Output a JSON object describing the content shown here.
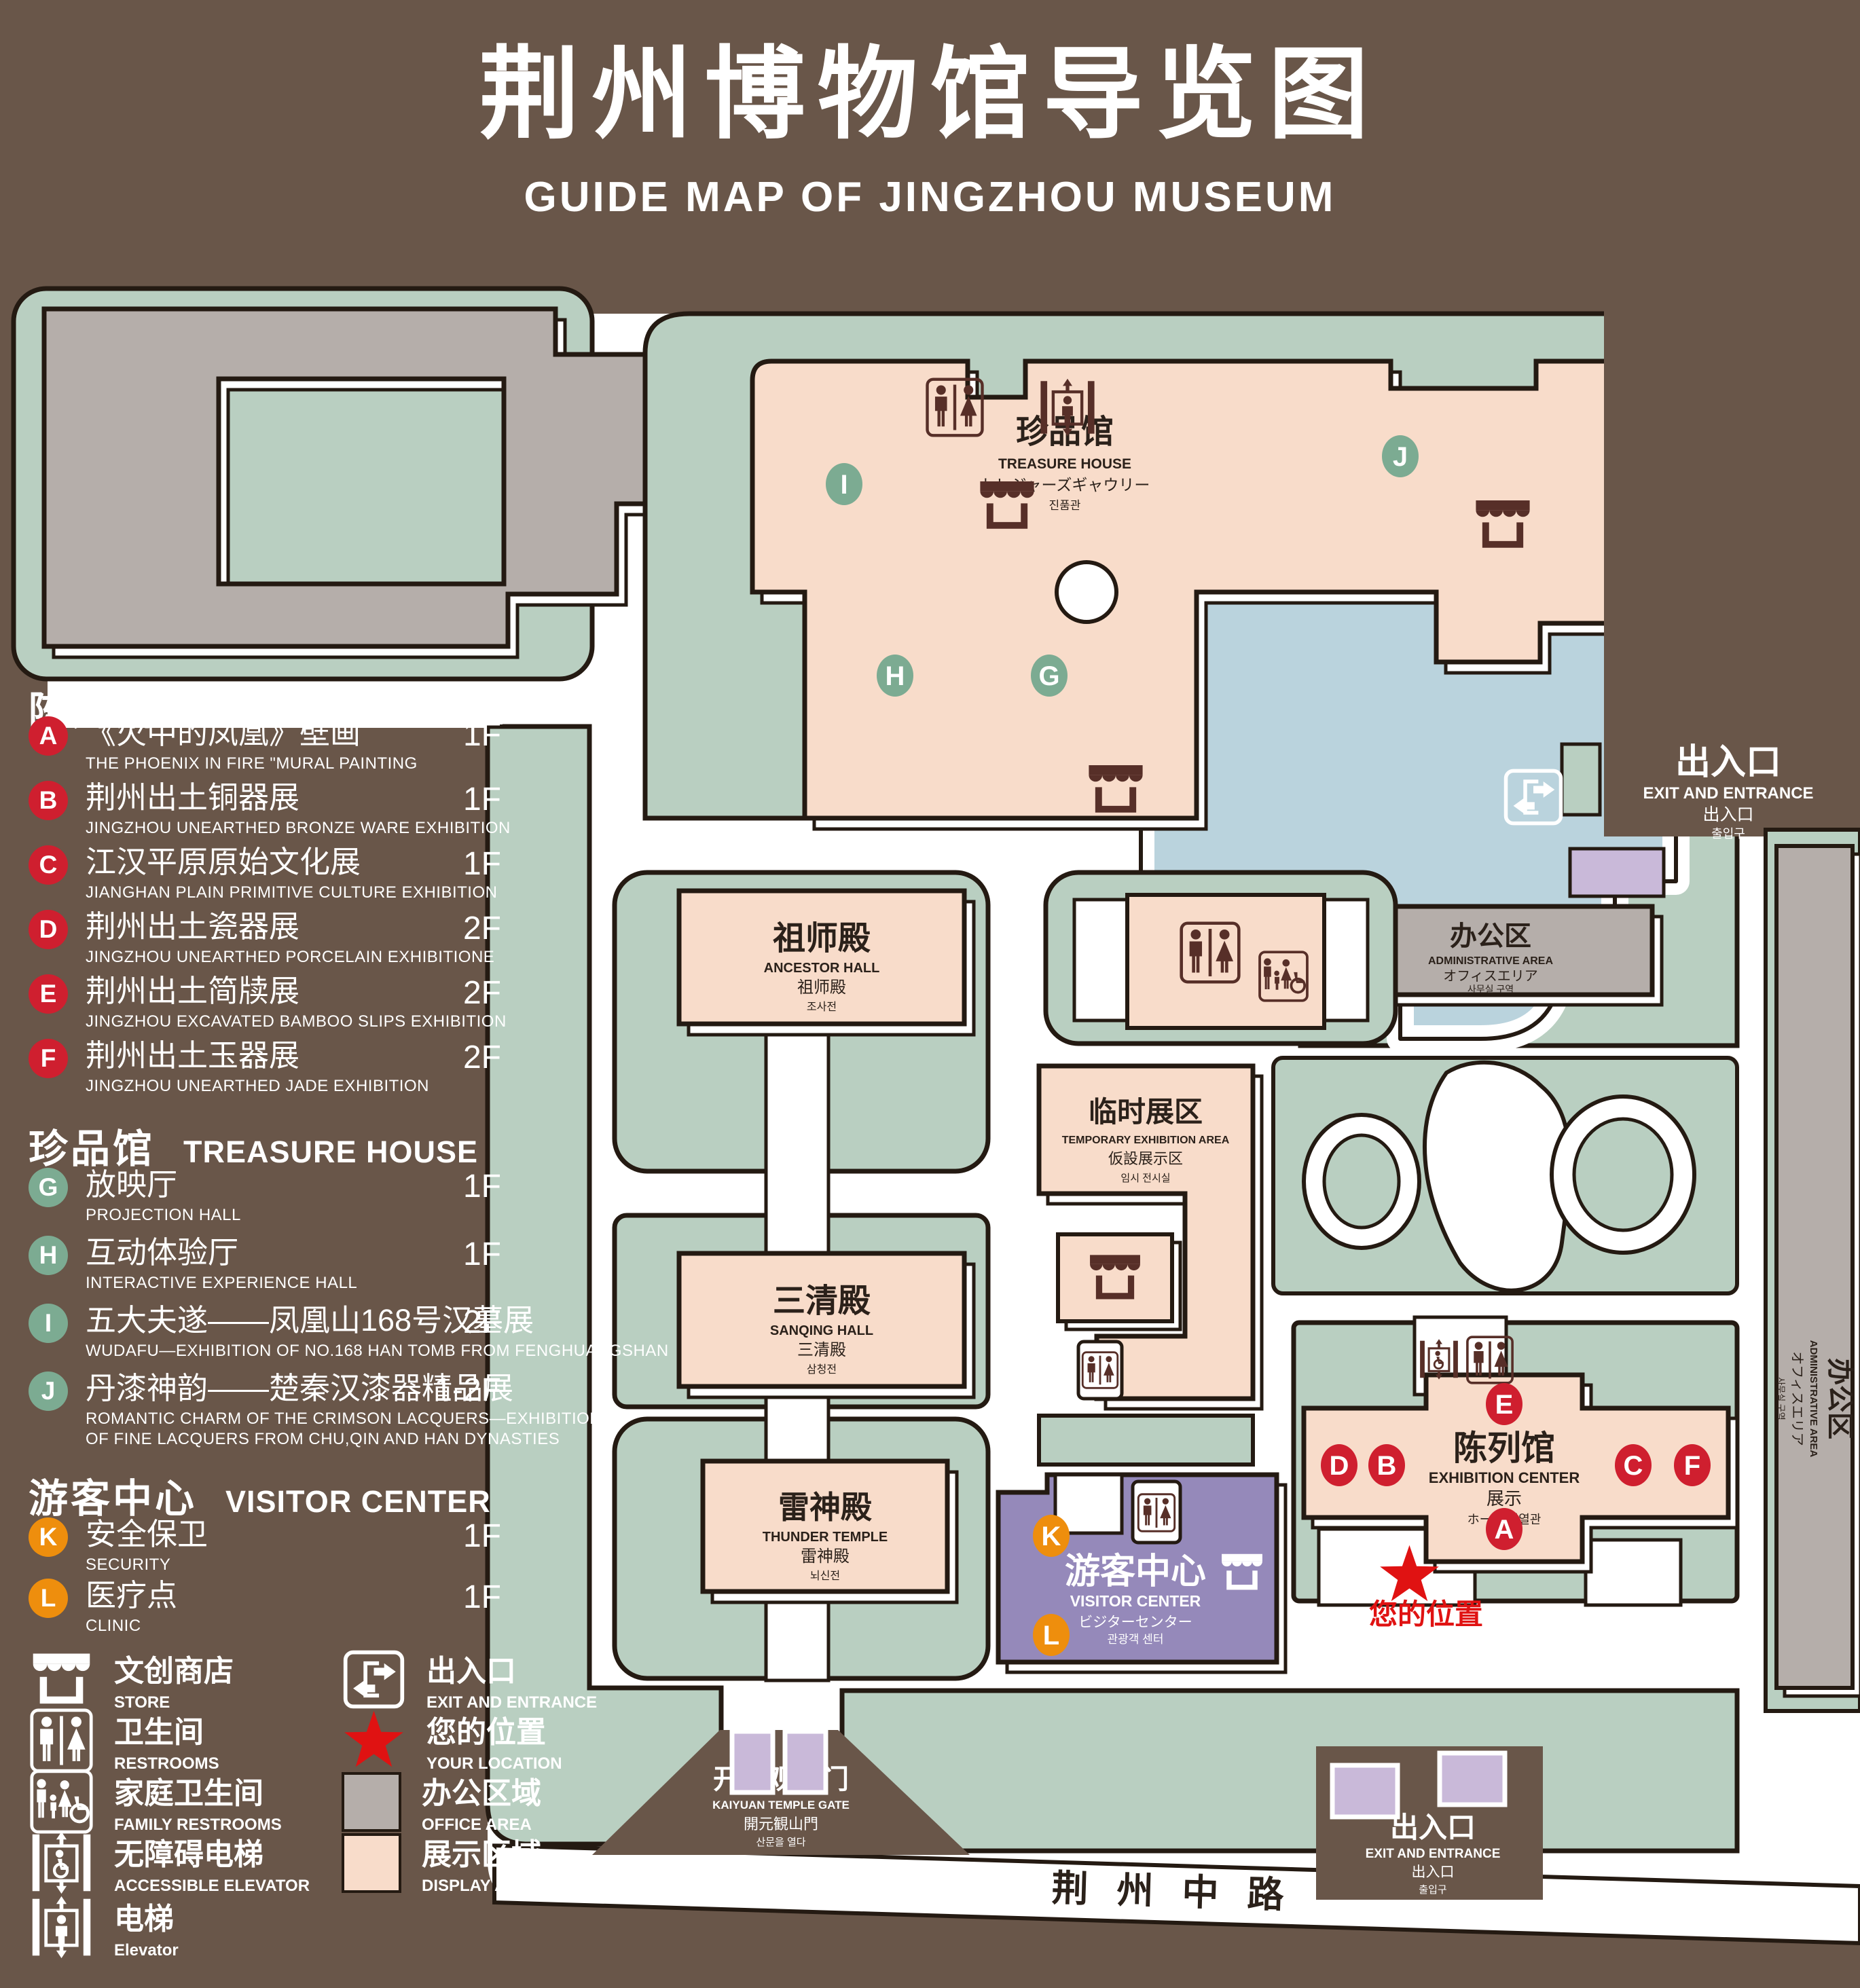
{
  "title": {
    "zh": "荆州博物馆导览图",
    "en": "GUIDE MAP OF JINGZHOU MUSEUM"
  },
  "colors": {
    "background": "#695649",
    "landscape_green": "#b9cfc1",
    "display_pink": "#f8dcca",
    "office_gray": "#b5aeaa",
    "water_blue": "#bad3dd",
    "visitor_purple": "#9589ba",
    "gate_purple": "#c9b9d9",
    "marker_red": "#cf1f2f",
    "marker_green": "#7cab92",
    "marker_orange": "#ee8e0d",
    "icon_brown": "#572f28",
    "star_red": "#e01212"
  },
  "legend": {
    "sections": [
      {
        "zh": "陈列馆",
        "en": "EXHIBITION CENTER",
        "items": [
          {
            "letter": "A",
            "zh": "《火中的凤凰》壁画",
            "en": "THE PHOENIX IN FIRE \"MURAL PAINTING",
            "floor": "1F"
          },
          {
            "letter": "B",
            "zh": "荆州出土铜器展",
            "en": "JINGZHOU UNEARTHED BRONZE WARE EXHIBITION",
            "floor": "1F"
          },
          {
            "letter": "C",
            "zh": "江汉平原原始文化展",
            "en": "JIANGHAN PLAIN PRIMITIVE CULTURE EXHIBITION",
            "floor": "1F"
          },
          {
            "letter": "D",
            "zh": "荆州出土瓷器展",
            "en": "JINGZHOU UNEARTHED PORCELAIN EXHIBITIONE",
            "floor": "2F"
          },
          {
            "letter": "E",
            "zh": "荆州出土简牍展",
            "en": "JINGZHOU EXCAVATED BAMBOO SLIPS EXHIBITION",
            "floor": "2F"
          },
          {
            "letter": "F",
            "zh": "荆州出土玉器展",
            "en": "JINGZHOU UNEARTHED JADE EXHIBITION",
            "floor": "2F"
          }
        ]
      },
      {
        "zh": "珍品馆",
        "en": "TREASURE HOUSE",
        "items": [
          {
            "letter": "G",
            "zh": "放映厅",
            "en": "PROJECTION HALL",
            "floor": "1F"
          },
          {
            "letter": "H",
            "zh": "互动体验厅",
            "en": "INTERACTIVE EXPERIENCE HALL",
            "floor": "1F"
          },
          {
            "letter": "I",
            "zh": "五大夫遂——凤凰山168号汉墓展",
            "en": "WUDAFU—EXHIBITION OF NO.168 HAN TOMB FROM FENGHUANGSHAN",
            "floor": "2F"
          },
          {
            "letter": "J",
            "zh": "丹漆神韵——楚秦汉漆器精品展",
            "en": "ROMANTIC CHARM OF THE CRIMSON LACQUERS—EXHIBITIONS",
            "en2": "OF FINE LACQUERS FROM CHU,QIN AND HAN DYNASTIES",
            "floor": "1-2F"
          }
        ]
      },
      {
        "zh": "游客中心",
        "en": "VISITOR CENTER",
        "items": [
          {
            "letter": "K",
            "zh": "安全保卫",
            "en": "SECURITY",
            "floor": "1F"
          },
          {
            "letter": "L",
            "zh": "医疗点",
            "en": "CLINIC",
            "floor": "1F"
          }
        ]
      }
    ],
    "symbols_left": [
      {
        "icon": "store-icon",
        "zh": "文创商店",
        "en": "STORE"
      },
      {
        "icon": "restrooms-icon",
        "zh": "卫生间",
        "en": "RESTROOMS"
      },
      {
        "icon": "family-restrooms-icon",
        "zh": "家庭卫生间",
        "en": "FAMILY RESTROOMS"
      },
      {
        "icon": "accessible-elevator-icon",
        "zh": "无障碍电梯",
        "en": "ACCESSIBLE ELEVATOR"
      },
      {
        "icon": "elevator-icon",
        "zh": "电梯",
        "en": "Elevator"
      }
    ],
    "symbols_right": [
      {
        "icon": "exit-icon",
        "zh": "出入口",
        "en": "EXIT AND ENTRANCE"
      },
      {
        "icon": "location-star-icon",
        "zh": "您的位置",
        "en": "YOUR LOCATION"
      },
      {
        "icon": "office-area-swatch",
        "zh": "办公区域",
        "en": "OFFICE AREA"
      },
      {
        "icon": "display-area-swatch",
        "zh": "展示区域",
        "en": "DISPLAY AREA"
      }
    ]
  },
  "map": {
    "admin_nw": {
      "zh": "办公区",
      "en": "ADMINISTRATIVE AREA",
      "jp": "オフィスエリア",
      "kr": "사무실 구역"
    },
    "admin_mid": {
      "zh": "办公区",
      "en": "ADMINISTRATIVE AREA",
      "jp": "オフィスエリア",
      "kr": "사무실 구역"
    },
    "admin_right": {
      "zh": "办公区",
      "en": "ADMINISTRATIVE AREA",
      "jp": "オフィスエリア",
      "kr": "사무실 구역"
    },
    "treasure": {
      "zh": "珍品馆",
      "en": "TREASURE HOUSE",
      "jp": "トレジャーズギャウリー",
      "kr": "진품관"
    },
    "ancestor": {
      "zh": "祖师殿",
      "en": "ANCESTOR HALL",
      "zh2": "祖师殿",
      "kr": "조사전"
    },
    "sanqing": {
      "zh": "三清殿",
      "en": "SANQING HALL",
      "zh2": "三清殿",
      "kr": "삼청전"
    },
    "thunder": {
      "zh": "雷神殿",
      "en": "THUNDER TEMPLE",
      "zh2": "雷神殿",
      "kr": "뇌신전"
    },
    "temporary": {
      "zh": "临时展区",
      "en": "TEMPORARY EXHIBITION AREA",
      "jp": "仮設展示区",
      "kr": "임시 전시실"
    },
    "visitor": {
      "zh": "游客中心",
      "en": "VISITOR CENTER",
      "jp": "ビジターセンター",
      "kr": "관광객 센터"
    },
    "exhibition": {
      "zh": "陈列馆",
      "en": "EXHIBITION CENTER",
      "zh2": "展示",
      "jpkr": "ホール 진열관"
    },
    "exit_top": {
      "zh": "出入口",
      "en": "EXIT AND ENTRANCE",
      "jp": "出入口",
      "kr": "출입구"
    },
    "exit_bottom": {
      "zh": "出入口",
      "en": "EXIT AND ENTRANCE",
      "jp": "出入口",
      "kr": "출입구"
    },
    "gate": {
      "zh": "开元观山门",
      "en": "KAIYUAN TEMPLE GATE",
      "jp": "開元観山門",
      "kr": "산문을 열다"
    },
    "road": {
      "zh": "荆州中路"
    },
    "your_location": {
      "zh": "您的位置"
    },
    "markers": {
      "A": "A",
      "B": "B",
      "C": "C",
      "D": "D",
      "E": "E",
      "F": "F",
      "G": "G",
      "H": "H",
      "I": "I",
      "J": "J",
      "K": "K",
      "L": "L"
    }
  }
}
